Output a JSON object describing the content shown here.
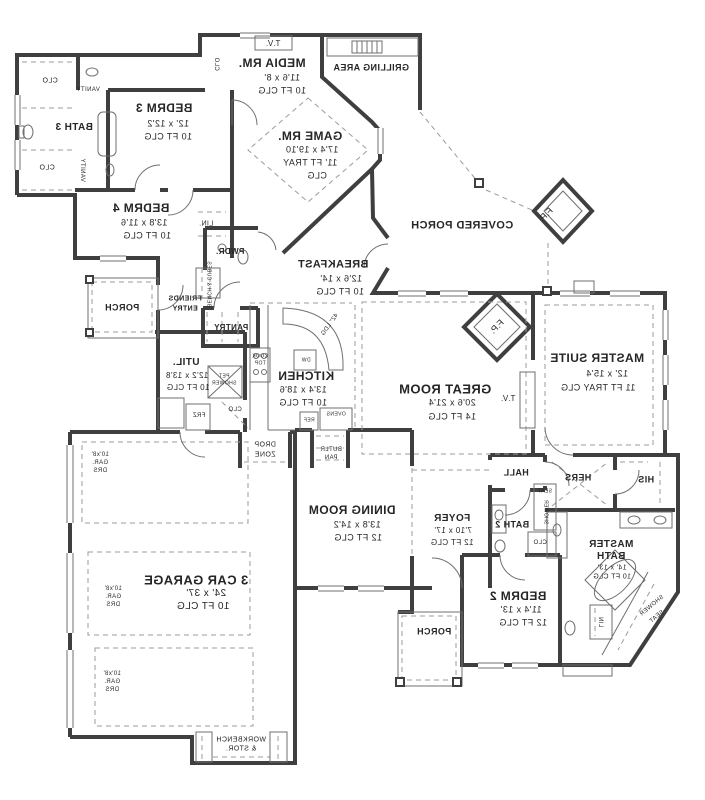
{
  "plan": {
    "type": "architectural floor plan",
    "mirrored": true,
    "colors": {
      "wall": "#3f3f3f",
      "thin_line": "#6f6f6f",
      "dashed_line": "#9b9b9b",
      "text": "#262626",
      "background": "#ffffff"
    },
    "labels": [
      {
        "t": "T.V.",
        "x": 273,
        "y": 44,
        "s": 8
      },
      {
        "t": "MEDIA RM.",
        "x": 272,
        "y": 63,
        "s": 12,
        "b": 1
      },
      {
        "t": "11'6 x 8'",
        "x": 282,
        "y": 78,
        "s": 9
      },
      {
        "t": "10 FT CLG",
        "x": 282,
        "y": 91,
        "s": 9
      },
      {
        "t": "CLO",
        "x": 216,
        "y": 64,
        "s": 6,
        "r": 90
      },
      {
        "t": "GRILLING AREA",
        "x": 371,
        "y": 68,
        "s": 9,
        "b": 1
      },
      {
        "t": "BEDRM 3",
        "x": 164,
        "y": 108,
        "s": 12,
        "b": 1
      },
      {
        "t": "12' x 12'2",
        "x": 168,
        "y": 124,
        "s": 9
      },
      {
        "t": "10 FT CLG",
        "x": 168,
        "y": 137,
        "s": 9
      },
      {
        "t": "CLO",
        "x": 50,
        "y": 81,
        "s": 7
      },
      {
        "t": "VANITY",
        "x": 88,
        "y": 90,
        "s": 6
      },
      {
        "t": "BATH 3",
        "x": 74,
        "y": 128,
        "s": 10,
        "b": 1
      },
      {
        "t": "CLO",
        "x": 47,
        "y": 168,
        "s": 7
      },
      {
        "t": "VANITY",
        "x": 82,
        "y": 170,
        "s": 6,
        "r": 90
      },
      {
        "t": "GAME RM.",
        "x": 310,
        "y": 136,
        "s": 12,
        "b": 1
      },
      {
        "t": "17'4 x 19'10",
        "x": 312,
        "y": 150,
        "s": 9
      },
      {
        "t": "11' FT TRAY",
        "x": 310,
        "y": 163,
        "s": 9
      },
      {
        "t": "CLG",
        "x": 317,
        "y": 176,
        "s": 9
      },
      {
        "t": "BEDRM 4",
        "x": 141,
        "y": 208,
        "s": 12,
        "b": 1
      },
      {
        "t": "13'8 x 11'6",
        "x": 144,
        "y": 223,
        "s": 9
      },
      {
        "t": "10 FT CLG",
        "x": 147,
        "y": 236,
        "s": 9
      },
      {
        "t": "LIN.",
        "x": 206,
        "y": 224,
        "s": 7
      },
      {
        "t": "COVERED PORCH",
        "x": 462,
        "y": 226,
        "s": 11,
        "b": 1
      },
      {
        "t": "F.P.",
        "x": 546,
        "y": 215,
        "s": 9,
        "r": -45
      },
      {
        "t": "BREAKFAST",
        "x": 333,
        "y": 265,
        "s": 11,
        "b": 1
      },
      {
        "t": "12'6 x 14'",
        "x": 341,
        "y": 279,
        "s": 9
      },
      {
        "t": "10 FT CLG",
        "x": 340,
        "y": 292,
        "s": 9
      },
      {
        "t": "PWDR.",
        "x": 230,
        "y": 252,
        "s": 8,
        "b": 1
      },
      {
        "t": "PORCH",
        "x": 122,
        "y": 308,
        "s": 9,
        "b": 1
      },
      {
        "t": "FRIENDS",
        "x": 185,
        "y": 299,
        "s": 7,
        "b": 1
      },
      {
        "t": "ENTRY",
        "x": 185,
        "y": 309,
        "s": 7,
        "b": 1
      },
      {
        "t": "BENCH & CUBES",
        "x": 208,
        "y": 284,
        "s": 5,
        "r": 90
      },
      {
        "t": "PANTRY",
        "x": 231,
        "y": 328,
        "s": 8,
        "b": 1
      },
      {
        "t": "MASTER SUITE",
        "x": 597,
        "y": 358,
        "s": 12,
        "b": 1
      },
      {
        "t": "12' x 15'4",
        "x": 607,
        "y": 374,
        "s": 9
      },
      {
        "t": "11 FT TRAY CLG",
        "x": 598,
        "y": 388,
        "s": 9
      },
      {
        "t": "F.P.",
        "x": 497,
        "y": 327,
        "s": 9,
        "r": -45
      },
      {
        "t": "T.V.",
        "x": 508,
        "y": 399,
        "s": 8
      },
      {
        "t": "GREAT ROOM",
        "x": 445,
        "y": 389,
        "s": 13,
        "b": 1
      },
      {
        "t": "20'6 x 21'4",
        "x": 452,
        "y": 403,
        "s": 9
      },
      {
        "t": "14 FT CLG",
        "x": 452,
        "y": 417,
        "s": 9
      },
      {
        "t": "OVENS",
        "x": 336,
        "y": 415,
        "s": 5
      },
      {
        "t": "REF",
        "x": 309,
        "y": 421,
        "s": 5
      },
      {
        "t": "BUTLR",
        "x": 331,
        "y": 450,
        "s": 6
      },
      {
        "t": "PAN",
        "x": 331,
        "y": 458,
        "s": 6
      },
      {
        "t": "KITCHEN",
        "x": 306,
        "y": 376,
        "s": 12,
        "b": 1
      },
      {
        "t": "13'4 x 18'6",
        "x": 303,
        "y": 390,
        "s": 9
      },
      {
        "t": "10 FT CLG",
        "x": 303,
        "y": 403,
        "s": 9
      },
      {
        "t": "COOK",
        "x": 260,
        "y": 357,
        "s": 5
      },
      {
        "t": "TOP",
        "x": 260,
        "y": 364,
        "s": 5
      },
      {
        "t": "DW",
        "x": 306,
        "y": 361,
        "s": 5
      },
      {
        "t": "42\" LDG",
        "x": 330,
        "y": 325,
        "s": 6,
        "r": -55
      },
      {
        "t": "UTIL.",
        "x": 186,
        "y": 363,
        "s": 10,
        "b": 1
      },
      {
        "t": "12'2 x 13'8",
        "x": 187,
        "y": 376,
        "s": 8
      },
      {
        "t": "10 FT CLG",
        "x": 188,
        "y": 388,
        "s": 8
      },
      {
        "t": "PET",
        "x": 224,
        "y": 377,
        "s": 5
      },
      {
        "t": "SHOWER",
        "x": 224,
        "y": 384,
        "s": 5
      },
      {
        "t": "CLO",
        "x": 235,
        "y": 410,
        "s": 6
      },
      {
        "t": "FRZ",
        "x": 199,
        "y": 416,
        "s": 6
      },
      {
        "t": "DROP",
        "x": 265,
        "y": 445,
        "s": 7
      },
      {
        "t": "ZONE",
        "x": 265,
        "y": 455,
        "s": 7
      },
      {
        "t": "DINING ROOM",
        "x": 352,
        "y": 510,
        "s": 12,
        "b": 1
      },
      {
        "t": "13'8 x 14'2",
        "x": 357,
        "y": 525,
        "s": 9
      },
      {
        "t": "12 FT CLG",
        "x": 358,
        "y": 538,
        "s": 9
      },
      {
        "t": "FOYER",
        "x": 452,
        "y": 519,
        "s": 10,
        "b": 1
      },
      {
        "t": "7'10 x 17'",
        "x": 453,
        "y": 531,
        "s": 8
      },
      {
        "t": "12 FT CLG",
        "x": 452,
        "y": 543,
        "s": 8
      },
      {
        "t": "HALL",
        "x": 516,
        "y": 473,
        "s": 9,
        "b": 1
      },
      {
        "t": "HERS",
        "x": 578,
        "y": 478,
        "s": 9,
        "b": 1
      },
      {
        "t": "HIS",
        "x": 646,
        "y": 480,
        "s": 9,
        "b": 1
      },
      {
        "t": "SEAT",
        "x": 545,
        "y": 492,
        "s": 5
      },
      {
        "t": "SHOWER",
        "x": 545,
        "y": 512,
        "s": 5,
        "r": 90
      },
      {
        "t": "CLO",
        "x": 540,
        "y": 543,
        "s": 6
      },
      {
        "t": "BATH 2",
        "x": 512,
        "y": 525,
        "s": 9,
        "b": 1
      },
      {
        "t": "MASTER",
        "x": 611,
        "y": 545,
        "s": 10,
        "b": 1
      },
      {
        "t": "BATH",
        "x": 611,
        "y": 557,
        "s": 10,
        "b": 1
      },
      {
        "t": "14' x 13'",
        "x": 612,
        "y": 568,
        "s": 7
      },
      {
        "t": "10 FT CLG",
        "x": 612,
        "y": 577,
        "s": 7
      },
      {
        "t": "BEDRM 2",
        "x": 518,
        "y": 596,
        "s": 12,
        "b": 1
      },
      {
        "t": "11'4 x 13'",
        "x": 521,
        "y": 610,
        "s": 9
      },
      {
        "t": "12 FT CLG",
        "x": 523,
        "y": 623,
        "s": 9
      },
      {
        "t": "SHOWER",
        "x": 652,
        "y": 606,
        "s": 6,
        "r": -40
      },
      {
        "t": "SEAT",
        "x": 657,
        "y": 617,
        "s": 6,
        "r": -40
      },
      {
        "t": "LIN",
        "x": 600,
        "y": 622,
        "s": 6,
        "r": 90
      },
      {
        "t": "3 CAR GARAGE",
        "x": 196,
        "y": 580,
        "s": 13,
        "b": 1
      },
      {
        "t": "24' x 37'",
        "x": 206,
        "y": 594,
        "s": 10
      },
      {
        "t": "10 FT CLG",
        "x": 203,
        "y": 607,
        "s": 10
      },
      {
        "t": "10'x8'",
        "x": 100,
        "y": 455,
        "s": 6
      },
      {
        "t": "GAR.",
        "x": 100,
        "y": 463,
        "s": 6
      },
      {
        "t": "DRS",
        "x": 100,
        "y": 471,
        "s": 6
      },
      {
        "t": "10'x8'",
        "x": 113,
        "y": 589,
        "s": 6
      },
      {
        "t": "GAR.",
        "x": 113,
        "y": 597,
        "s": 6
      },
      {
        "t": "DRS",
        "x": 113,
        "y": 605,
        "s": 6
      },
      {
        "t": "10'x8'",
        "x": 112,
        "y": 674,
        "s": 6
      },
      {
        "t": "GAR.",
        "x": 112,
        "y": 682,
        "s": 6
      },
      {
        "t": "DRS",
        "x": 112,
        "y": 690,
        "s": 6
      },
      {
        "t": "WORKBENCH",
        "x": 241,
        "y": 740,
        "s": 7
      },
      {
        "t": "& STOR.",
        "x": 241,
        "y": 749,
        "s": 7
      },
      {
        "t": "PORCH",
        "x": 434,
        "y": 632,
        "s": 9,
        "b": 1
      }
    ]
  }
}
